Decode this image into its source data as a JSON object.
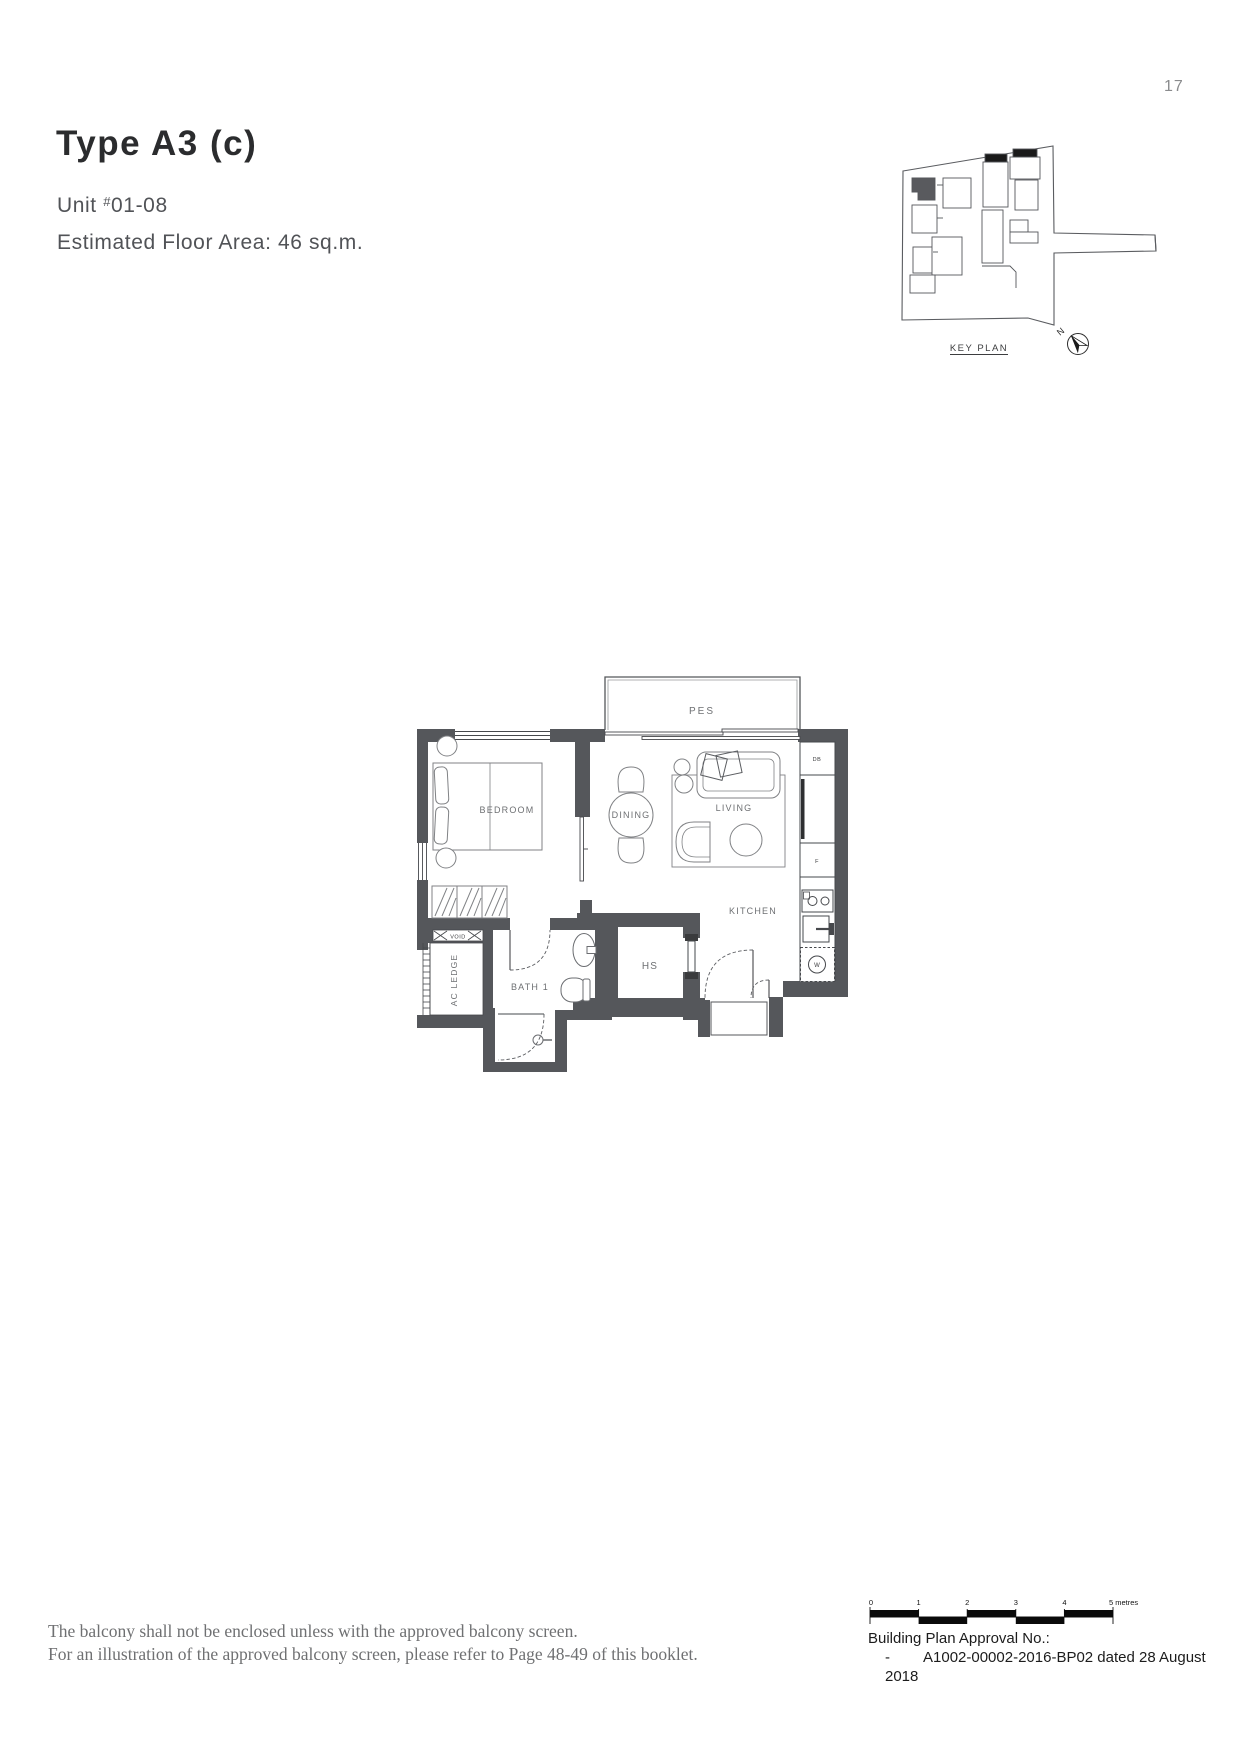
{
  "page": {
    "number": "17"
  },
  "header": {
    "title": "Type A3 (c)",
    "unit_prefix": "Unit ",
    "unit_hash": "#",
    "unit_number": "01-08",
    "floor_area": "Estimated Floor Area: 46 sq.m."
  },
  "key_plan": {
    "label": "KEY PLAN",
    "north_label": "N"
  },
  "floor_plan": {
    "rooms": {
      "pes": "PES",
      "bedroom": "BEDROOM",
      "dining": "DINING",
      "living": "LIVING",
      "kitchen": "KITCHEN",
      "hs": "HS",
      "bath1": "BATH 1",
      "ac_ledge": "AC LEDGE",
      "void": "VOID"
    },
    "fixtures": {
      "db": "DB",
      "fridge": "F",
      "washer": "W"
    },
    "colors": {
      "wall": "#55575b",
      "line": "#46484c",
      "furniture": "#808285",
      "label": "#6e7073"
    }
  },
  "footer": {
    "note_line1": "The balcony shall not be enclosed unless with the approved balcony screen.",
    "note_line2": "For an illustration of the approved balcony screen, please refer to Page 48-49 of this booklet.",
    "approval_heading": "Building Plan Approval No.:",
    "approval_dash": "-",
    "approval_value": "A1002-00002-2016-BP02 dated 28 August 2018",
    "scalebar": {
      "ticks": [
        "0",
        "1",
        "2",
        "3",
        "4"
      ],
      "end_label": "5 metres"
    }
  }
}
